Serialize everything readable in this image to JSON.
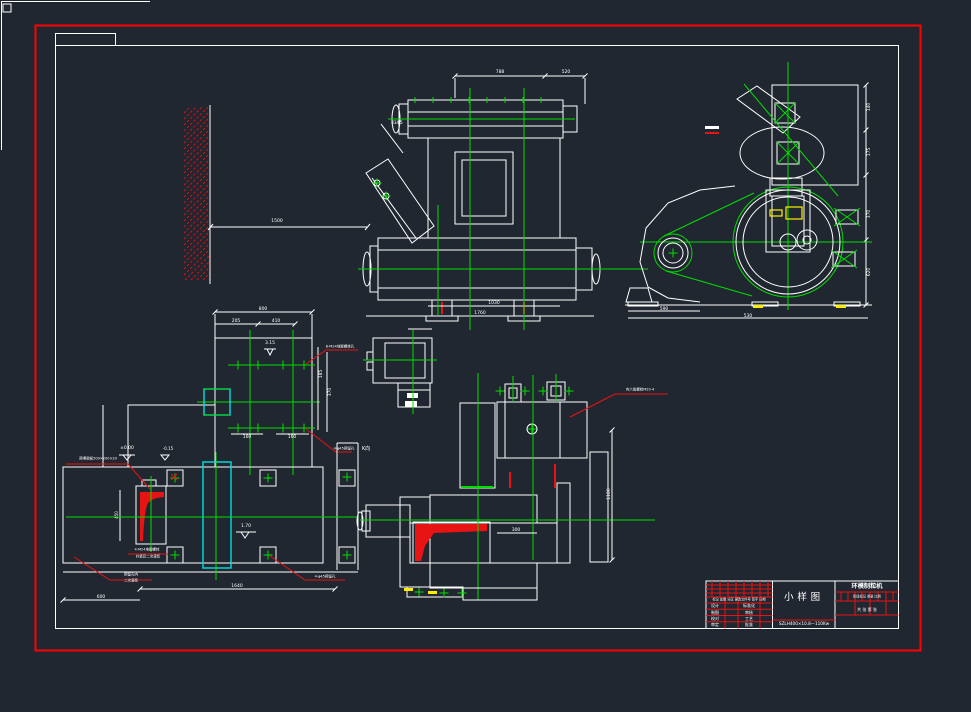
{
  "canvas": {
    "width": 971,
    "height": 712,
    "background": "#212731"
  },
  "colors": {
    "outline": "#ffffff",
    "centerline_green": "#00dd00",
    "annotation_red": "#e81313",
    "frame_red": "#ff0000",
    "slot_cyan": "#00e0e0",
    "highlight_yellow": "#ffee00"
  },
  "title_block": {
    "drawing_title": "小样图",
    "product_name": "环模制粒机",
    "model_text": "SZLH400×10.8—110Kw",
    "sheet_text": "共  张  第  张",
    "rev_header": "标记 处数 分区 更改文件号 签字 日期",
    "stage_header": "阶段标记  重量  比例",
    "rows": [
      {
        "left": "设计",
        "right": "标准化"
      },
      {
        "left": "制图",
        "right": "审核"
      },
      {
        "left": "校对",
        "right": "工艺"
      },
      {
        "left": "审定",
        "right": "批准"
      }
    ]
  },
  "annotations": [
    {
      "x": 500,
      "y": 72,
      "t": "788",
      "s": 4.5
    },
    {
      "x": 566,
      "y": 72,
      "t": "520",
      "s": 4.5
    },
    {
      "x": 397,
      "y": 123,
      "t": "834.5",
      "s": 4
    },
    {
      "x": 277,
      "y": 221,
      "t": "1500",
      "s": 4.5
    },
    {
      "x": 494,
      "y": 303,
      "t": "1030",
      "s": 4.5
    },
    {
      "x": 480,
      "y": 313,
      "t": "1760",
      "s": 4.5
    },
    {
      "x": 869,
      "y": 107,
      "t": "140",
      "s": 4.5,
      "r": -90
    },
    {
      "x": 869,
      "y": 152,
      "t": "175",
      "s": 4.5,
      "r": -90
    },
    {
      "x": 869,
      "y": 214,
      "t": "370",
      "s": 4.5,
      "r": -90
    },
    {
      "x": 869,
      "y": 272,
      "t": "620",
      "s": 4.5,
      "r": -90
    },
    {
      "x": 664,
      "y": 309,
      "t": "590",
      "s": 4.5
    },
    {
      "x": 748,
      "y": 316,
      "t": "530",
      "s": 4.5
    },
    {
      "x": 263,
      "y": 309,
      "t": "800",
      "s": 4.5
    },
    {
      "x": 236,
      "y": 321,
      "t": "205",
      "s": 4.5
    },
    {
      "x": 276,
      "y": 321,
      "t": "410",
      "s": 4.5
    },
    {
      "x": 270,
      "y": 343,
      "t": "3.15",
      "s": 4.5
    },
    {
      "x": 321,
      "y": 374,
      "t": "185",
      "s": 4.5,
      "r": -90
    },
    {
      "x": 330,
      "y": 392,
      "t": "370",
      "s": 4.5,
      "r": -90
    },
    {
      "x": 247,
      "y": 437,
      "t": "160",
      "s": 4.5
    },
    {
      "x": 292,
      "y": 437,
      "t": "160",
      "s": 4.5
    },
    {
      "x": 127,
      "y": 448,
      "t": "±0.00",
      "s": 4.5
    },
    {
      "x": 168,
      "y": 449,
      "t": "-0.15",
      "s": 4
    },
    {
      "x": 340,
      "y": 347,
      "t": "8-M24地脚螺栓孔",
      "s": 3.5
    },
    {
      "x": 344,
      "y": 449,
      "t": "4-φ45预留孔",
      "s": 3.5
    },
    {
      "x": 98,
      "y": 459,
      "t": "预埋钢板500×200×20",
      "s": 3.5
    },
    {
      "x": 117,
      "y": 515,
      "t": "450",
      "s": 4,
      "r": -90
    },
    {
      "x": 147,
      "y": 550,
      "t": "4-M24地脚螺栓",
      "s": 3.5
    },
    {
      "x": 148,
      "y": 557,
      "t": "拧紧后二次灌浆",
      "s": 3.5
    },
    {
      "x": 131,
      "y": 575,
      "t": "预留孔内",
      "s": 3.5
    },
    {
      "x": 131,
      "y": 581,
      "t": "二次灌浆",
      "s": 3.5
    },
    {
      "x": 246,
      "y": 526,
      "t": "1.70",
      "s": 4.5
    },
    {
      "x": 237,
      "y": 586,
      "t": "1640",
      "s": 4.5
    },
    {
      "x": 101,
      "y": 597,
      "t": "600",
      "s": 4.5
    },
    {
      "x": 325,
      "y": 577,
      "t": "4-φ45预留孔",
      "s": 3.5
    },
    {
      "x": 640,
      "y": 390,
      "t": "内六角螺栓M20-4",
      "s": 3.5
    },
    {
      "x": 609,
      "y": 494,
      "t": "1180",
      "s": 4.5,
      "r": -90
    },
    {
      "x": 516,
      "y": 530,
      "t": "300",
      "s": 4.5
    },
    {
      "x": 366,
      "y": 449,
      "t": "K向",
      "s": 5
    }
  ]
}
